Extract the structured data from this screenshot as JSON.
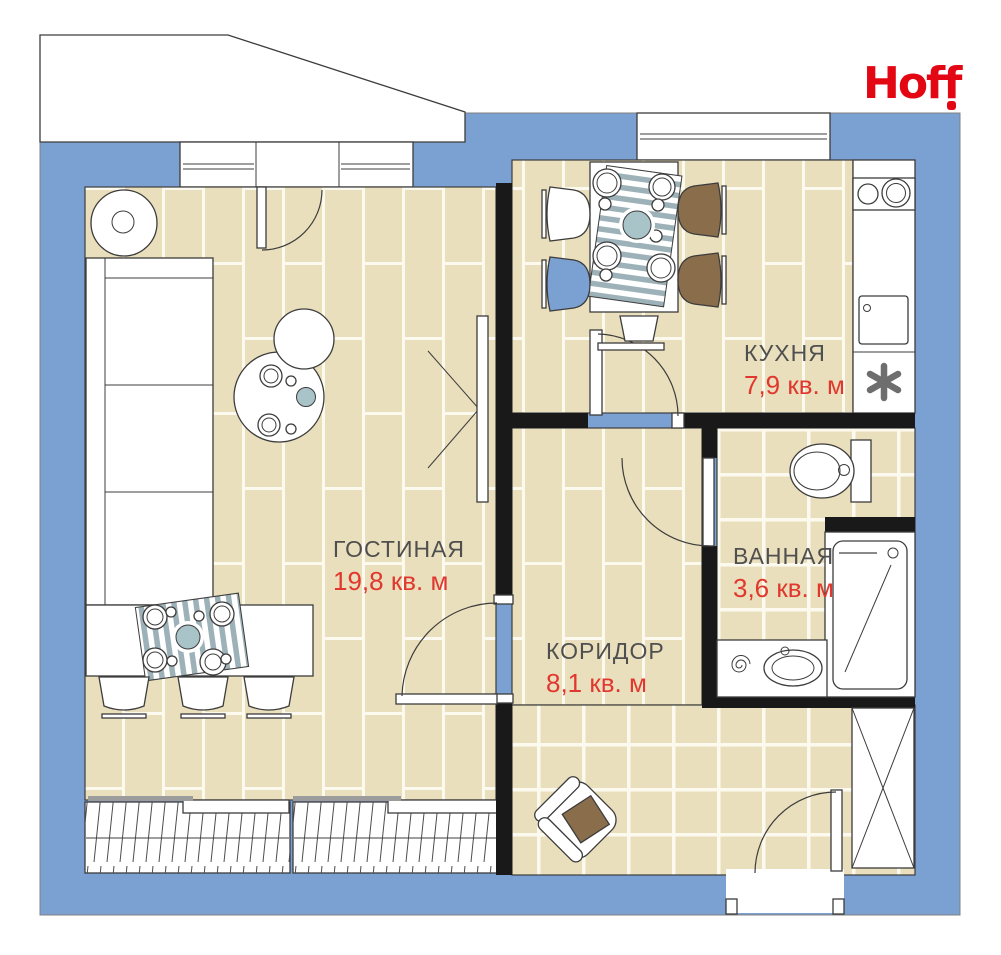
{
  "brand": {
    "logo_text": "Hoff"
  },
  "rooms": {
    "living": {
      "name": "ГОСТИНАЯ",
      "area": "19,8 кв. м"
    },
    "kitchen": {
      "name": "КУХНЯ",
      "area": "7,9 кв. м"
    },
    "bathroom": {
      "name": "ВАННАЯ",
      "area": "3,6 кв. м"
    },
    "corridor": {
      "name": "КОРИДОР",
      "area": "8,1 кв. м"
    }
  },
  "palette": {
    "wall_blue": "#7BA0D2",
    "floor_beige": "#EADFBC",
    "grout_white": "#FCFAEF",
    "accent_red": "#E0372F",
    "logo_red": "#E30613",
    "label_gray": "#4F4F4F",
    "wood_brown": "#8A6E4C",
    "textile_teal": "#9DB2B8",
    "bowl_teal": "#A9C4C9",
    "wall_black": "#191919"
  },
  "icons": {
    "water_heater_glyph": "✳",
    "names": [
      "floor-lamp-icon",
      "sofa-icon",
      "coffee-table-icon",
      "tv-icon",
      "dining-table-icon",
      "chair-icon",
      "table-runner-icon",
      "armchair-icon",
      "stove-icon",
      "kitchen-sink-icon",
      "water-heater-icon",
      "toilet-icon",
      "shower-icon",
      "washbasin-icon",
      "towel-swirl-icon",
      "wardrobe-icon",
      "door-swing-icon",
      "window-icon",
      "entry-door-icon",
      "balcony-icon"
    ]
  }
}
